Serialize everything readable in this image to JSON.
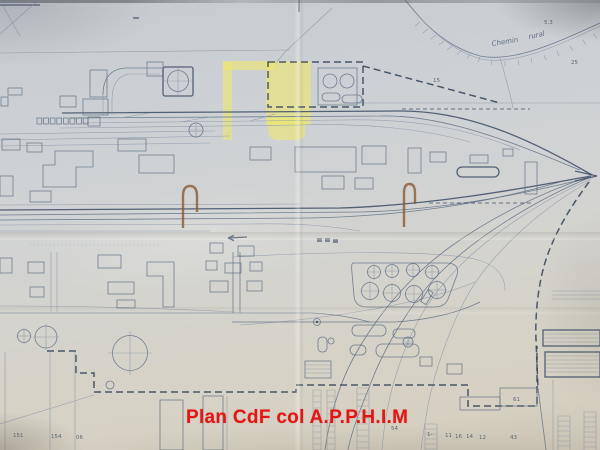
{
  "caption": {
    "text": "Plan CdF col A.P.P.H.I.M"
  },
  "plan": {
    "labels": [
      {
        "text": "Chemin"
      },
      {
        "text": "rural"
      },
      {
        "text": "15"
      },
      {
        "text": "25"
      },
      {
        "text": "5.3"
      },
      {
        "text": "61"
      },
      {
        "text": "54"
      },
      {
        "text": "43"
      },
      {
        "text": "12"
      },
      {
        "text": "14"
      },
      {
        "text": "16"
      },
      {
        "text": "11"
      },
      {
        "text": "1-"
      },
      {
        "text": "151"
      },
      {
        "text": "154"
      },
      {
        "text": "06"
      }
    ]
  },
  "palette": {
    "paper": "#d2d4d2",
    "paper_bottom": "#d6d0c1",
    "ink": "#5e6e84",
    "ink_dark": "#44536a",
    "boundary_dash": "#3b495d",
    "highlight_yellow": "#efe96a",
    "hook_brown": "#8a5a32",
    "caption_red": "#e31616"
  }
}
